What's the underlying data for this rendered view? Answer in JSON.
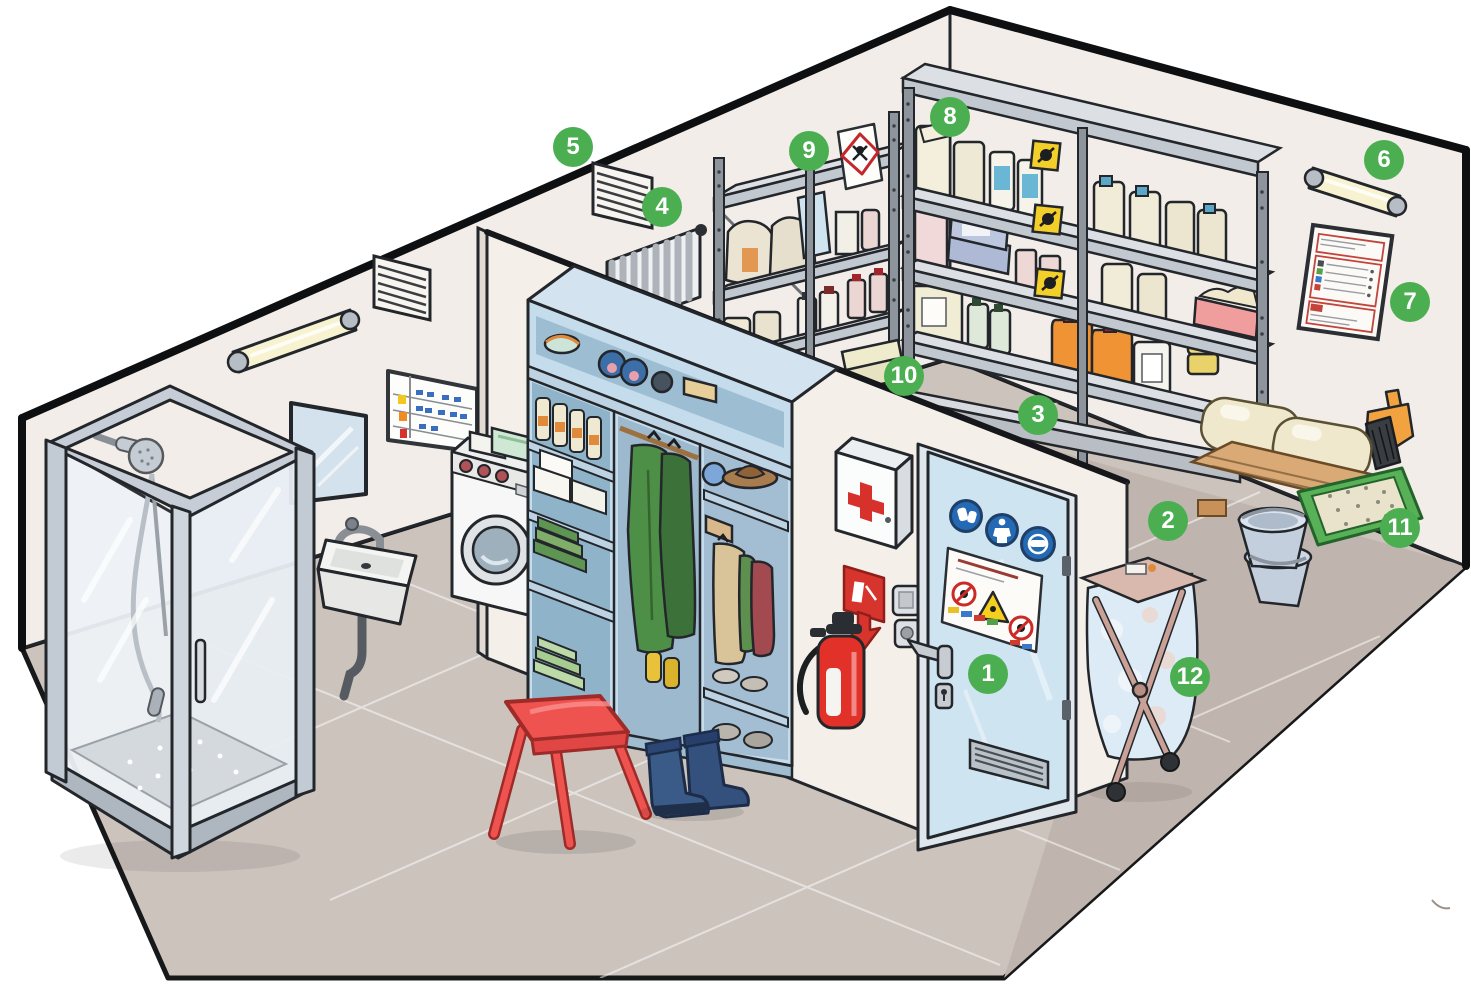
{
  "diagram": {
    "type": "isometric-cutaway-room-illustration",
    "subject": "chemical / phytosanitary product storage room with washing and changing area",
    "hotspot_style": "numbered-green-circles",
    "badge_color": "#4bae50",
    "badge_text_color": "#ffffff"
  },
  "badges": [
    {
      "number": "1"
    },
    {
      "number": "2"
    },
    {
      "number": "3"
    },
    {
      "number": "4"
    },
    {
      "number": "5"
    },
    {
      "number": "6"
    },
    {
      "number": "7"
    },
    {
      "number": "8"
    },
    {
      "number": "9"
    },
    {
      "number": "10"
    },
    {
      "number": "11"
    },
    {
      "number": "12"
    }
  ],
  "signage_icons": {
    "door_mandatory_signs": [
      "mandatory-gloves-sign",
      "mandatory-protective-suit-sign",
      "mandatory-face-protection-sign"
    ],
    "door_poster": "safety-instructions-poster-with-warning-triangle-and-prohibition-signs",
    "extinguisher_sign": "fire-extinguisher-sign-with-down-arrow",
    "first_aid_cabinet": "red-cross-icon",
    "small_shelf_sign": "ghs-hazard-diamond-pictogram",
    "large_shelf_labels": [
      "yellow-hazard-label-1",
      "yellow-hazard-label-2",
      "yellow-hazard-label-3"
    ],
    "wall_poster": "red-framed-product-register-poster",
    "planning_board": "wall-planning-board-with-colored-status-cells"
  },
  "scene_objects": [
    "shower-cabin",
    "wall-sink",
    "wall-mirror",
    "planning-board",
    "fluorescent-tube-light-left",
    "air-vent-left",
    "air-vent-upper",
    "radiator",
    "ppe-locker",
    "washing-machine",
    "red-stool",
    "rubber-boots",
    "first-aid-cabinet",
    "fire-extinguisher",
    "light-switch",
    "access-door",
    "small-chemical-shelf",
    "large-chemical-shelf",
    "retention-sill",
    "floor-level-packages",
    "fluorescent-tube-light-right",
    "wall-poster",
    "dustpan-and-brush",
    "wooden-pallet-with-sacks",
    "absorbent-granule-tray",
    "buckets",
    "laundry-cart"
  ],
  "palette": {
    "wall": "#f2ede8",
    "floor": "#ccc3bd",
    "floor_dark": "#c0b5ae",
    "locker_blue": "#c4dcec",
    "door_blue": "#cfe4f1",
    "steel_gray": "#d9dde2",
    "extinguisher_red": "#e23128",
    "stool_red": "#ef5350",
    "boots_navy": "#33517c",
    "tray_green": "#58b157",
    "jerrycan_orange": "#ef9334",
    "hazard_yellow": "#f3cf2a",
    "mandatory_blue": "#2469b3",
    "cross_red": "#d6312b",
    "outline": "#23262a"
  }
}
